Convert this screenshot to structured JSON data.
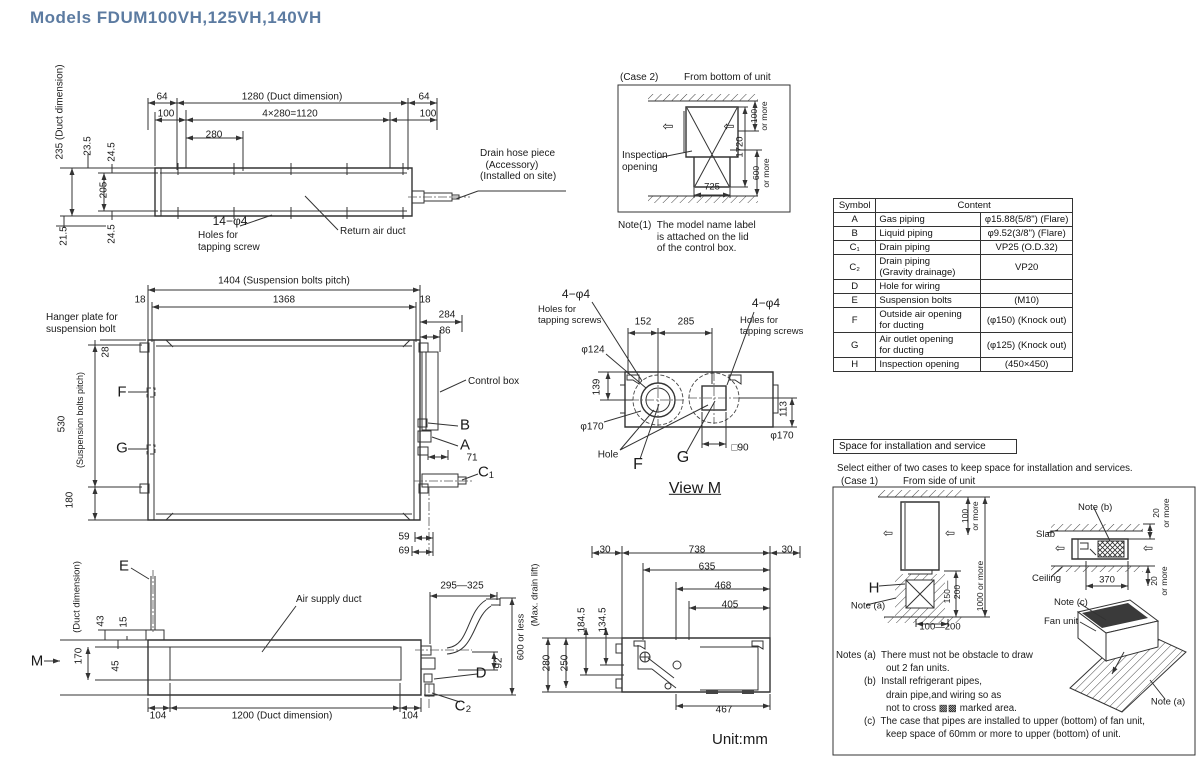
{
  "title": "Models  FDUM100VH,125VH,140VH",
  "colors": {
    "title_accent": "#5c7ba1",
    "line": "#333333"
  },
  "table": {
    "col_symbol": "Symbol",
    "col_content": "Content",
    "rows": [
      {
        "symbol": "A",
        "item": "Gas piping",
        "value": "φ15.88(5/8\") (Flare)"
      },
      {
        "symbol": "B",
        "item": "Liquid piping",
        "value": "φ9.52(3/8\") (Flare)"
      },
      {
        "symbol": "C₁",
        "item": "Drain piping",
        "value": "VP25 (O.D.32)"
      },
      {
        "symbol": "C₂",
        "item": "Drain piping\n(Gravity drainage)",
        "value": "VP20"
      },
      {
        "symbol": "D",
        "item": "Hole for wiring",
        "value": ""
      },
      {
        "symbol": "E",
        "item": "Suspension bolts",
        "value": "(M10)"
      },
      {
        "symbol": "F",
        "item": "Outside air opening\nfor ducting",
        "value": "(φ150) (Knock out)"
      },
      {
        "symbol": "G",
        "item": "Air outlet opening\nfor ducting",
        "value": "(φ125) (Knock out)"
      },
      {
        "symbol": "H",
        "item": "Inspection opening",
        "value": "(450×450)"
      }
    ]
  },
  "space": {
    "title": "Space for installation and service"
  },
  "labels": [
    {
      "n": "dim-235-duct-dimension",
      "x": 60,
      "y": 112,
      "t": "235 (Duct dimension)",
      "r": 1
    },
    {
      "n": "dim-23-5",
      "x": 88,
      "y": 146,
      "t": "23.5",
      "r": 1
    },
    {
      "n": "dim-24-5-top",
      "x": 112,
      "y": 152,
      "t": "24.5",
      "r": 1
    },
    {
      "n": "dim-205",
      "x": 104,
      "y": 190,
      "t": "205",
      "r": 1
    },
    {
      "n": "dim-21-5",
      "x": 64,
      "y": 236,
      "t": "21.5",
      "r": 1
    },
    {
      "n": "dim-24-5-bottom",
      "x": 112,
      "y": 234,
      "t": "24.5",
      "r": 1
    },
    {
      "n": "dim-64-left",
      "x": 162,
      "y": 97,
      "t": "64",
      "a": "c"
    },
    {
      "n": "dim-1280-duct",
      "x": 292,
      "y": 97,
      "t": "1280 (Duct dimension)",
      "a": "c"
    },
    {
      "n": "dim-100-left",
      "x": 166,
      "y": 114,
      "t": "100",
      "a": "c"
    },
    {
      "n": "dim-4x280",
      "x": 290,
      "y": 114,
      "t": "4×280=1120",
      "a": "c"
    },
    {
      "n": "dim-64-right",
      "x": 424,
      "y": 97,
      "t": "64",
      "a": "c"
    },
    {
      "n": "dim-100-right",
      "x": 428,
      "y": 114,
      "t": "100",
      "a": "c"
    },
    {
      "n": "dim-280",
      "x": 214,
      "y": 135,
      "t": "280",
      "a": "c"
    },
    {
      "n": "label-14-phi4",
      "x": 230,
      "y": 222,
      "t": "14−φ4",
      "a": "c",
      "s": 12
    },
    {
      "n": "label-holes-tapping-screw",
      "x": 198,
      "y": 230,
      "t": "Holes for\ntapping screw"
    },
    {
      "n": "label-return-air-duct",
      "x": 340,
      "y": 226,
      "t": "Return air duct"
    },
    {
      "n": "label-drain-hose-piece",
      "x": 480,
      "y": 148,
      "t": "Drain hose piece\n  (Accessory)\n(Installed on site)"
    },
    {
      "n": "case2-title",
      "x": 620,
      "y": 72,
      "t": "(Case 2)"
    },
    {
      "n": "case2-subtitle",
      "x": 684,
      "y": 72,
      "t": "From bottom of unit"
    },
    {
      "n": "label-inspection-opening",
      "x": 622,
      "y": 150,
      "t": "Inspection\nopening"
    },
    {
      "n": "dim-725",
      "x": 712,
      "y": 188,
      "t": "725",
      "a": "c",
      "s": 9.5
    },
    {
      "n": "dim-1720",
      "x": 741,
      "y": 147,
      "t": "1720",
      "r": 1,
      "s": 9.5
    },
    {
      "n": "dim-100-or-more-case2",
      "x": 760,
      "y": 116,
      "t": "100\nor more",
      "r": 1,
      "s": 8.5
    },
    {
      "n": "dim-600-or-more-case2",
      "x": 762,
      "y": 173,
      "t": "600\nor more",
      "r": 1,
      "s": 8.5
    },
    {
      "n": "arrow-left-case2-a",
      "x": 668,
      "y": 127,
      "t": "⇦",
      "a": "c",
      "s": 13
    },
    {
      "n": "arrow-left-case2-b",
      "x": 729,
      "y": 127,
      "t": "⇦",
      "a": "c",
      "s": 13
    },
    {
      "n": "note-1",
      "x": 618,
      "y": 220,
      "t": "Note(1)  The model name label\n              is attached on the lid\n              of the control box."
    },
    {
      "n": "dim-1404-pitch",
      "x": 284,
      "y": 281,
      "t": "1404 (Suspension bolts pitch)",
      "a": "c"
    },
    {
      "n": "dim-1368",
      "x": 284,
      "y": 300,
      "t": "1368",
      "a": "c"
    },
    {
      "n": "dim-18-left",
      "x": 140,
      "y": 300,
      "t": "18",
      "a": "c"
    },
    {
      "n": "dim-18-right",
      "x": 425,
      "y": 300,
      "t": "18",
      "a": "c"
    },
    {
      "n": "dim-284",
      "x": 447,
      "y": 315,
      "t": "284",
      "a": "c"
    },
    {
      "n": "dim-86",
      "x": 445,
      "y": 331,
      "t": "86",
      "a": "c"
    },
    {
      "n": "label-hanger-plate",
      "x": 46,
      "y": 312,
      "t": "Hanger plate for\nsuspension bolt"
    },
    {
      "n": "dim-28",
      "x": 106,
      "y": 352,
      "t": "28",
      "r": 1
    },
    {
      "n": "dim-530",
      "x": 62,
      "y": 424,
      "t": "530",
      "r": 1
    },
    {
      "n": "label-suspension-pitch-vert",
      "x": 80,
      "y": 420,
      "t": "(Suspension bolts pitch)",
      "r": 1,
      "s": 9
    },
    {
      "n": "dim-180",
      "x": 70,
      "y": 500,
      "t": "180",
      "r": 1
    },
    {
      "n": "label-F-mid",
      "x": 122,
      "y": 392,
      "t": "F",
      "a": "c",
      "s": 15
    },
    {
      "n": "label-G-mid",
      "x": 122,
      "y": 448,
      "t": "G",
      "a": "c",
      "s": 15
    },
    {
      "n": "label-control-box",
      "x": 468,
      "y": 376,
      "t": "Control box"
    },
    {
      "n": "label-B-mid",
      "x": 465,
      "y": 425,
      "t": "B",
      "a": "c",
      "s": 15
    },
    {
      "n": "label-A-mid",
      "x": 465,
      "y": 445,
      "t": "A",
      "a": "c",
      "s": 15
    },
    {
      "n": "dim-71",
      "x": 472,
      "y": 458,
      "t": "71",
      "a": "c"
    },
    {
      "n": "label-C1-mid",
      "x": 486,
      "y": 472,
      "t": "C₁",
      "a": "c",
      "s": 15
    },
    {
      "n": "dim-59",
      "x": 404,
      "y": 537,
      "t": "59",
      "a": "c"
    },
    {
      "n": "dim-69",
      "x": 404,
      "y": 551,
      "t": "69",
      "a": "c"
    },
    {
      "n": "dim-4phi4-left",
      "x": 576,
      "y": 295,
      "t": "4−φ4",
      "a": "c",
      "s": 12
    },
    {
      "n": "label-holes-tapping-left",
      "x": 538,
      "y": 305,
      "t": "Holes for\ntapping screws",
      "s": 9.5
    },
    {
      "n": "dim-4phi4-right",
      "x": 766,
      "y": 304,
      "t": "4−φ4",
      "a": "c",
      "s": 12
    },
    {
      "n": "label-holes-tapping-right",
      "x": 740,
      "y": 316,
      "t": "Holes for\ntapping screws",
      "s": 9.5
    },
    {
      "n": "dim-152",
      "x": 643,
      "y": 322,
      "t": "152",
      "a": "c"
    },
    {
      "n": "dim-285",
      "x": 686,
      "y": 322,
      "t": "285",
      "a": "c"
    },
    {
      "n": "dim-phi124",
      "x": 593,
      "y": 350,
      "t": "φ124",
      "a": "c"
    },
    {
      "n": "dim-139",
      "x": 597,
      "y": 387,
      "t": "139",
      "r": 1
    },
    {
      "n": "dim-phi170-left",
      "x": 592,
      "y": 427,
      "t": "φ170",
      "a": "c"
    },
    {
      "n": "dim-phi170-right",
      "x": 782,
      "y": 436,
      "t": "φ170",
      "a": "c"
    },
    {
      "n": "dim-113",
      "x": 784,
      "y": 409,
      "t": "113",
      "r": 1
    },
    {
      "n": "label-hole",
      "x": 608,
      "y": 455,
      "t": "Hole",
      "a": "c"
    },
    {
      "n": "label-F-viewm",
      "x": 638,
      "y": 465,
      "t": "F",
      "a": "c",
      "s": 16
    },
    {
      "n": "label-G-viewm",
      "x": 683,
      "y": 458,
      "t": "G",
      "a": "c",
      "s": 16
    },
    {
      "n": "dim-sq90",
      "x": 740,
      "y": 448,
      "t": "□90",
      "a": "c"
    },
    {
      "n": "label-view-m",
      "x": 695,
      "y": 489,
      "t": "View M",
      "a": "c",
      "s": 16,
      "u": 1
    },
    {
      "n": "label-E",
      "x": 124,
      "y": 566,
      "t": "E",
      "a": "c",
      "s": 15
    },
    {
      "n": "label-air-supply-duct",
      "x": 296,
      "y": 594,
      "t": "Air supply duct"
    },
    {
      "n": "label-duct-dimension-vert",
      "x": 78,
      "y": 597,
      "t": "(Duct dimension)",
      "r": 1,
      "s": 9.5
    },
    {
      "n": "dim-170-duct",
      "x": 79,
      "y": 656,
      "t": "170",
      "r": 1
    },
    {
      "n": "dim-43",
      "x": 101,
      "y": 621,
      "t": "43",
      "r": 1
    },
    {
      "n": "dim-15",
      "x": 124,
      "y": 622,
      "t": "15",
      "r": 1
    },
    {
      "n": "dim-45",
      "x": 116,
      "y": 666,
      "t": "45",
      "r": 1
    },
    {
      "n": "label-M",
      "x": 37,
      "y": 661,
      "t": "M",
      "a": "c",
      "s": 15
    },
    {
      "n": "dim-104-left",
      "x": 158,
      "y": 716,
      "t": "104",
      "a": "c"
    },
    {
      "n": "dim-1200-duct",
      "x": 282,
      "y": 716,
      "t": "1200 (Duct dimension)",
      "a": "c"
    },
    {
      "n": "dim-104-right",
      "x": 410,
      "y": 716,
      "t": "104",
      "a": "c"
    },
    {
      "n": "dim-295-325",
      "x": 462,
      "y": 586,
      "t": "295—325",
      "a": "c"
    },
    {
      "n": "dim-92",
      "x": 499,
      "y": 663,
      "t": "92",
      "r": 1
    },
    {
      "n": "label-D",
      "x": 481,
      "y": 673,
      "t": "D",
      "a": "c",
      "s": 15
    },
    {
      "n": "label-C2",
      "x": 463,
      "y": 706,
      "t": "C₂",
      "a": "c",
      "s": 15
    },
    {
      "n": "dim-600-or-less",
      "x": 522,
      "y": 637,
      "t": "600 or less",
      "r": 1,
      "s": 9.5
    },
    {
      "n": "label-max-drain-lift",
      "x": 536,
      "y": 595,
      "t": "(Max. drain lift)",
      "r": 1,
      "s": 9.5
    },
    {
      "n": "dim-30-left",
      "x": 605,
      "y": 550,
      "t": "30",
      "a": "c"
    },
    {
      "n": "dim-738",
      "x": 697,
      "y": 550,
      "t": "738",
      "a": "c"
    },
    {
      "n": "dim-30-right",
      "x": 787,
      "y": 550,
      "t": "30",
      "a": "c"
    },
    {
      "n": "dim-635",
      "x": 707,
      "y": 567,
      "t": "635",
      "a": "c"
    },
    {
      "n": "dim-468",
      "x": 723,
      "y": 586,
      "t": "468",
      "a": "c"
    },
    {
      "n": "dim-405",
      "x": 730,
      "y": 605,
      "t": "405",
      "a": "c"
    },
    {
      "n": "dim-184-5",
      "x": 582,
      "y": 620,
      "t": "184.5",
      "r": 1
    },
    {
      "n": "dim-134-5",
      "x": 603,
      "y": 620,
      "t": "134.5",
      "r": 1
    },
    {
      "n": "dim-280-vert",
      "x": 547,
      "y": 663,
      "t": "280",
      "r": 1
    },
    {
      "n": "dim-250-vert",
      "x": 565,
      "y": 663,
      "t": "250",
      "r": 1
    },
    {
      "n": "dim-467",
      "x": 724,
      "y": 710,
      "t": "467",
      "a": "c"
    },
    {
      "n": "label-unit-mm",
      "x": 712,
      "y": 731,
      "t": "Unit:mm",
      "s": 15
    },
    {
      "n": "space-select-note",
      "x": 837,
      "y": 463,
      "t": "Select either of two cases to keep space for installation and services.",
      "s": 9.7
    },
    {
      "n": "case1-title",
      "x": 841,
      "y": 476,
      "t": "(Case 1)",
      "s": 9.7
    },
    {
      "n": "case1-subtitle",
      "x": 903,
      "y": 476,
      "t": "From side of unit",
      "s": 9.7
    },
    {
      "n": "dim-100-or-more-case1",
      "x": 971,
      "y": 516,
      "t": "100\nor more",
      "r": 1,
      "s": 8.5
    },
    {
      "n": "label-H",
      "x": 874,
      "y": 588,
      "t": "H",
      "a": "c",
      "s": 15
    },
    {
      "n": "note-a-label-left",
      "x": 868,
      "y": 607,
      "t": "Note (a)",
      "a": "c",
      "s": 9.5
    },
    {
      "n": "dim-150-200",
      "x": 953,
      "y": 592,
      "t": "150—\n200",
      "r": 1,
      "s": 8.5
    },
    {
      "n": "dim-1000-or-more",
      "x": 981,
      "y": 586,
      "t": "1000 or more",
      "r": 1,
      "s": 8.5
    },
    {
      "n": "dim-100-200",
      "x": 940,
      "y": 628,
      "t": "100—200",
      "a": "c",
      "s": 9.5
    },
    {
      "n": "note-b-label",
      "x": 1078,
      "y": 503,
      "t": "Note (b)",
      "s": 9.5
    },
    {
      "n": "label-slab",
      "x": 1036,
      "y": 530,
      "t": "Slab",
      "s": 9.5
    },
    {
      "n": "label-ceiling",
      "x": 1032,
      "y": 574,
      "t": "Ceiling",
      "s": 9.5
    },
    {
      "n": "dim-370",
      "x": 1107,
      "y": 581,
      "t": "370",
      "a": "c",
      "s": 9.5
    },
    {
      "n": "dim-20-or-more-top",
      "x": 1162,
      "y": 513,
      "t": "20\nor more",
      "r": 1,
      "s": 8.5
    },
    {
      "n": "dim-20-or-more-bottom",
      "x": 1160,
      "y": 581,
      "t": "20\nor more",
      "r": 1,
      "s": 8.5
    },
    {
      "n": "note-c-label",
      "x": 1054,
      "y": 598,
      "t": "Note (c)",
      "s": 9.5
    },
    {
      "n": "label-fan-unit",
      "x": 1044,
      "y": 617,
      "t": "Fan unit",
      "s": 9.5
    },
    {
      "n": "note-a-label-right",
      "x": 1168,
      "y": 703,
      "t": "Note (a)",
      "a": "c",
      "s": 9.5
    },
    {
      "n": "arrow-left-case1-a",
      "x": 888,
      "y": 534,
      "t": "⇦",
      "a": "c",
      "s": 12
    },
    {
      "n": "arrow-left-case1-b",
      "x": 950,
      "y": 534,
      "t": "⇦",
      "a": "c",
      "s": 12
    },
    {
      "n": "arrow-left-case1r-a",
      "x": 1060,
      "y": 549,
      "t": "⇦",
      "a": "c",
      "s": 12
    },
    {
      "n": "arrow-left-case1r-b",
      "x": 1148,
      "y": 549,
      "t": "⇦",
      "a": "c",
      "s": 12
    },
    {
      "n": "notes-line-1",
      "x": 836,
      "y": 650,
      "t": "Notes (a)  There must not be obstacle to draw",
      "s": 9.7
    },
    {
      "n": "notes-line-2",
      "x": 886,
      "y": 663,
      "t": "out 2 fan units.",
      "s": 9.7
    },
    {
      "n": "notes-line-3",
      "x": 864,
      "y": 676,
      "t": "(b)  Install refrigerant pipes,",
      "s": 9.7
    },
    {
      "n": "notes-line-4",
      "x": 886,
      "y": 690,
      "t": "drain pipe,and wiring so as",
      "s": 9.7
    },
    {
      "n": "notes-line-5",
      "x": 886,
      "y": 703,
      "t": "not to cross ▩▩ marked area.",
      "s": 9.7
    },
    {
      "n": "notes-line-6",
      "x": 864,
      "y": 716,
      "t": "(c)  The case that pipes are installed to upper (bottom) of fan unit,",
      "s": 9.7
    },
    {
      "n": "notes-line-7",
      "x": 886,
      "y": 729,
      "t": "keep space of 60mm or more to upper (bottom) of unit.",
      "s": 9.7
    }
  ]
}
